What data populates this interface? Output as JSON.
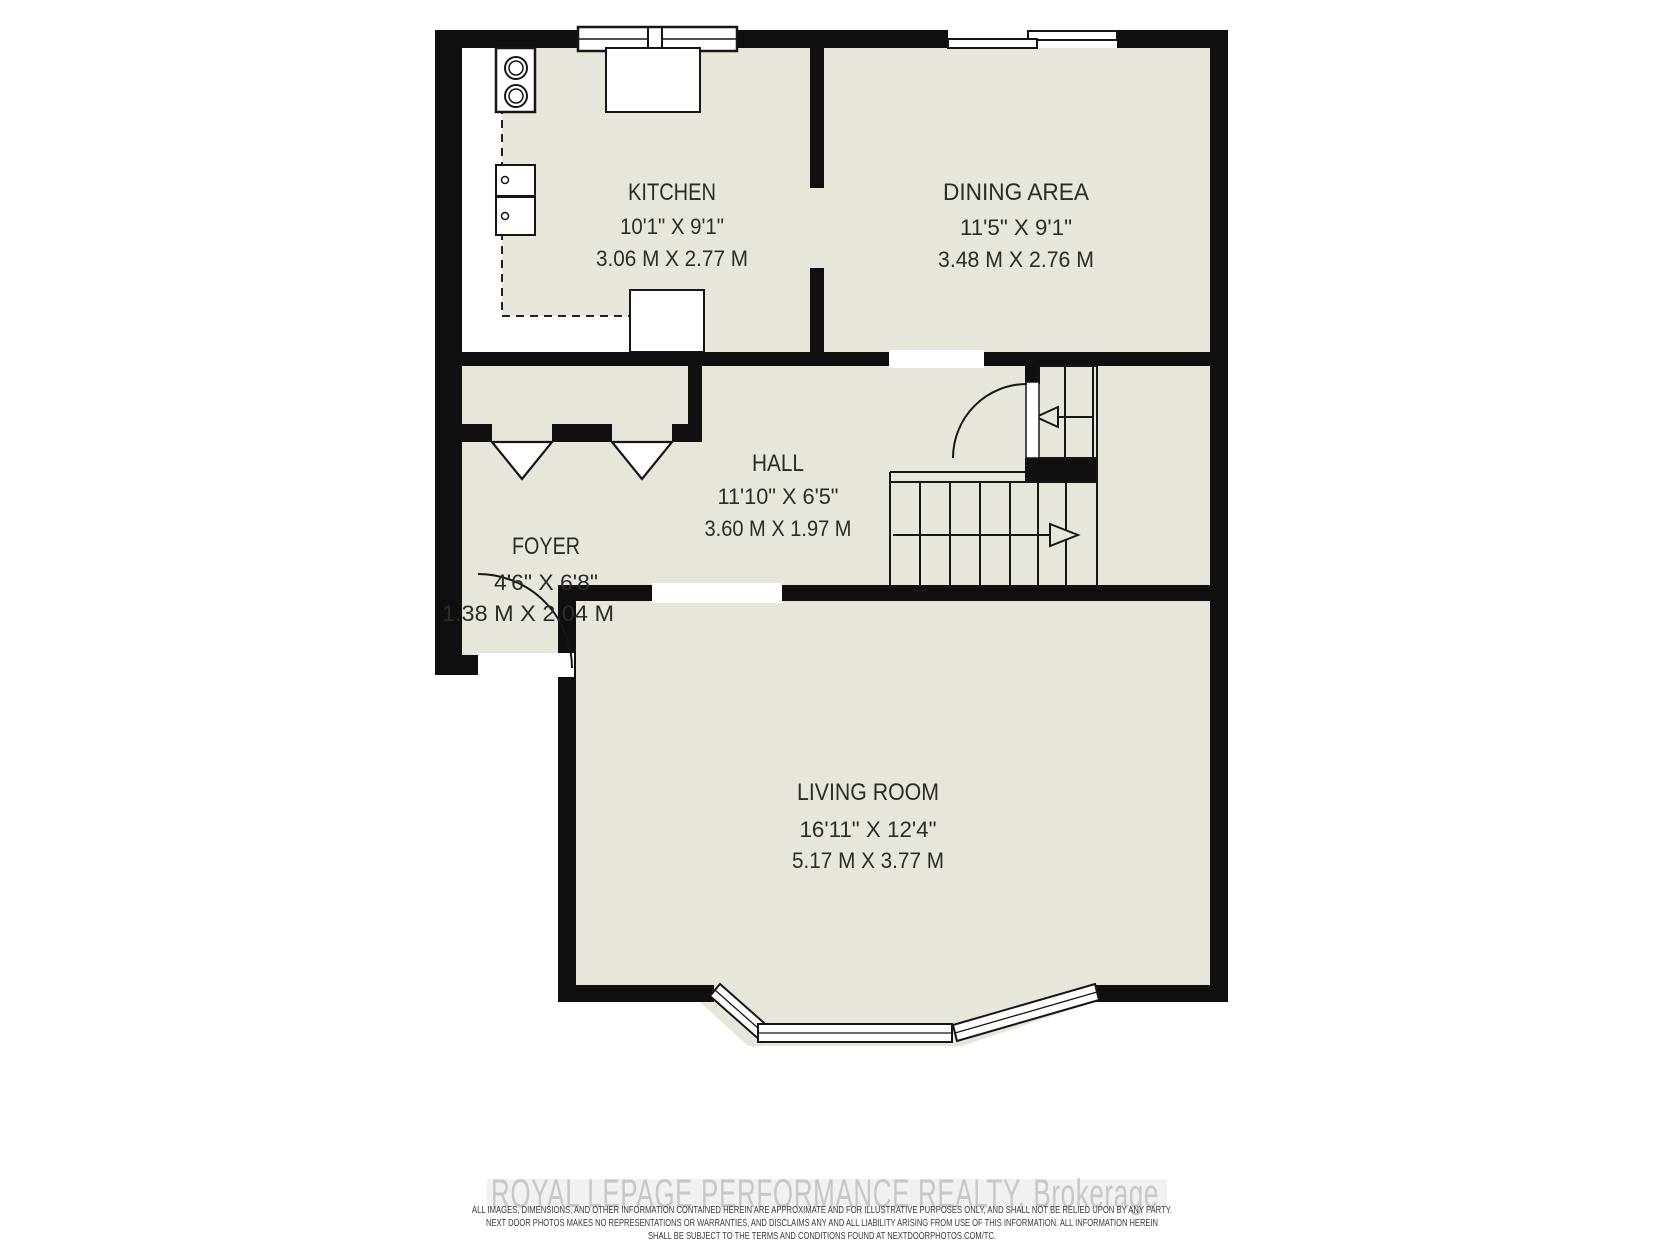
{
  "plan": {
    "rooms": {
      "kitchen": {
        "name": "KITCHEN",
        "imperial": "10'1\" X 9'1\"",
        "metric": "3.06 M X 2.77 M"
      },
      "dining": {
        "name": "DINING AREA",
        "imperial": "11'5\" X 9'1\"",
        "metric": "3.48 M X 2.76 M"
      },
      "hall": {
        "name": "HALL",
        "imperial": "11'10\" X 6'5\"",
        "metric": "3.60 M X 1.97 M"
      },
      "foyer": {
        "name": "FOYER",
        "imperial": "4'6\" X 6'8\"",
        "metric": "1.38 M X 2.04 M"
      },
      "living": {
        "name": "LIVING ROOM",
        "imperial": "16'11\" X 12'4\"",
        "metric": "5.17 M X 3.77 M"
      }
    },
    "colors": {
      "floor": "#e8e6da",
      "wall": "#0f0f0f",
      "label": "#2b2b2b",
      "watermark": "#c7c7c7",
      "disclaimer": "#3a3a3a"
    }
  },
  "footer": {
    "watermark": "ROYAL LEPAGE PERFORMANCE REALTY, Brokerage",
    "disclaimer_line1": "ALL IMAGES, DIMENSIONS, AND OTHER INFORMATION CONTAINED HEREIN ARE APPROXIMATE AND FOR ILLUSTRATIVE PURPOSES ONLY, AND SHALL NOT BE RELIED UPON BY ANY PARTY.",
    "disclaimer_line2": "NEXT DOOR PHOTOS MAKES NO REPRESENTATIONS OR WARRANTIES, AND DISCLAIMS ANY AND ALL LIABILITY ARISING FROM USE OF THIS INFORMATION. ALL INFORMATION HEREIN",
    "disclaimer_line3": "SHALL BE SUBJECT TO THE TERMS AND CONDITIONS FOUND AT NEXTDOORPHOTOS.COM/TC."
  }
}
